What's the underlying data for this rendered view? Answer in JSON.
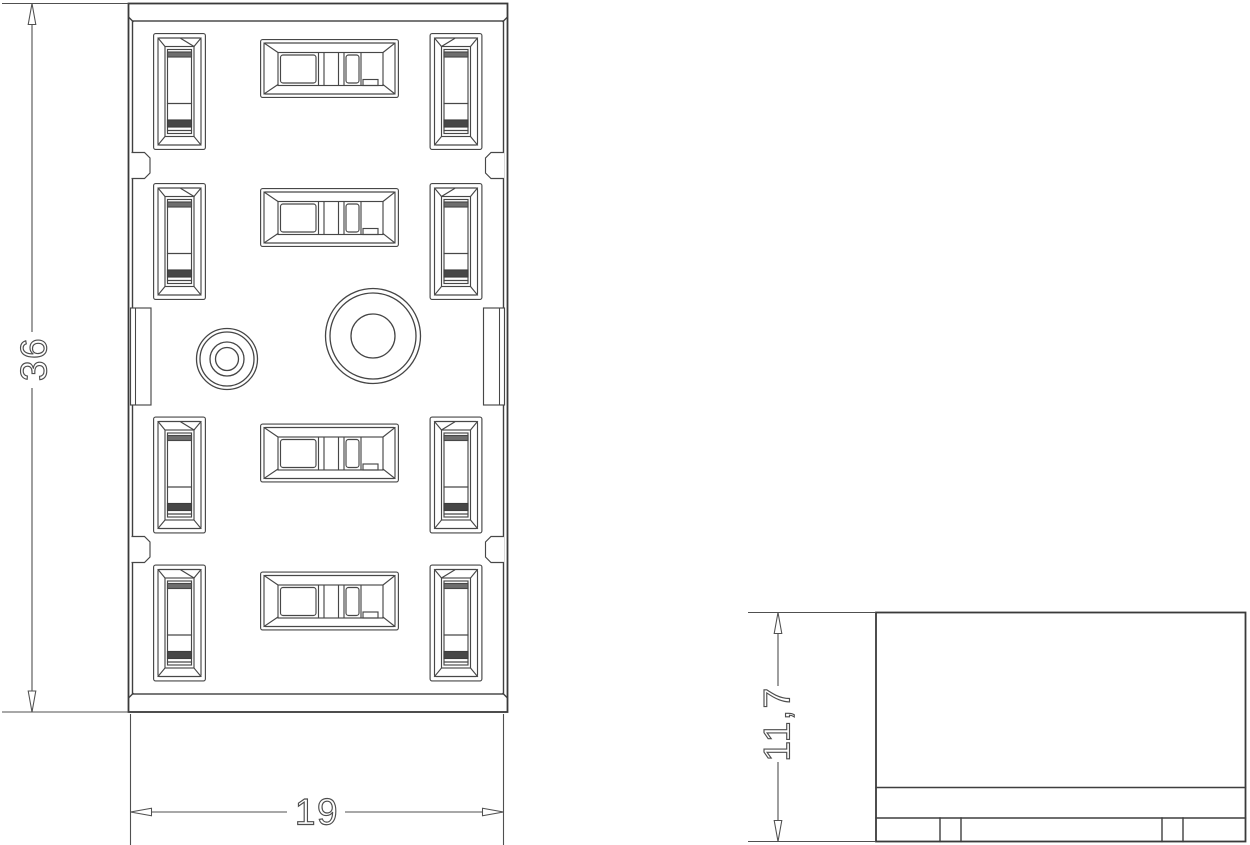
{
  "drawing": {
    "background_color": "#ffffff",
    "line_color": "#3f3f3f",
    "dimension_color": "#505050",
    "views": {
      "front": {
        "height_label": "36",
        "width_label": "19"
      },
      "side": {
        "height_label": "11,7"
      }
    }
  }
}
